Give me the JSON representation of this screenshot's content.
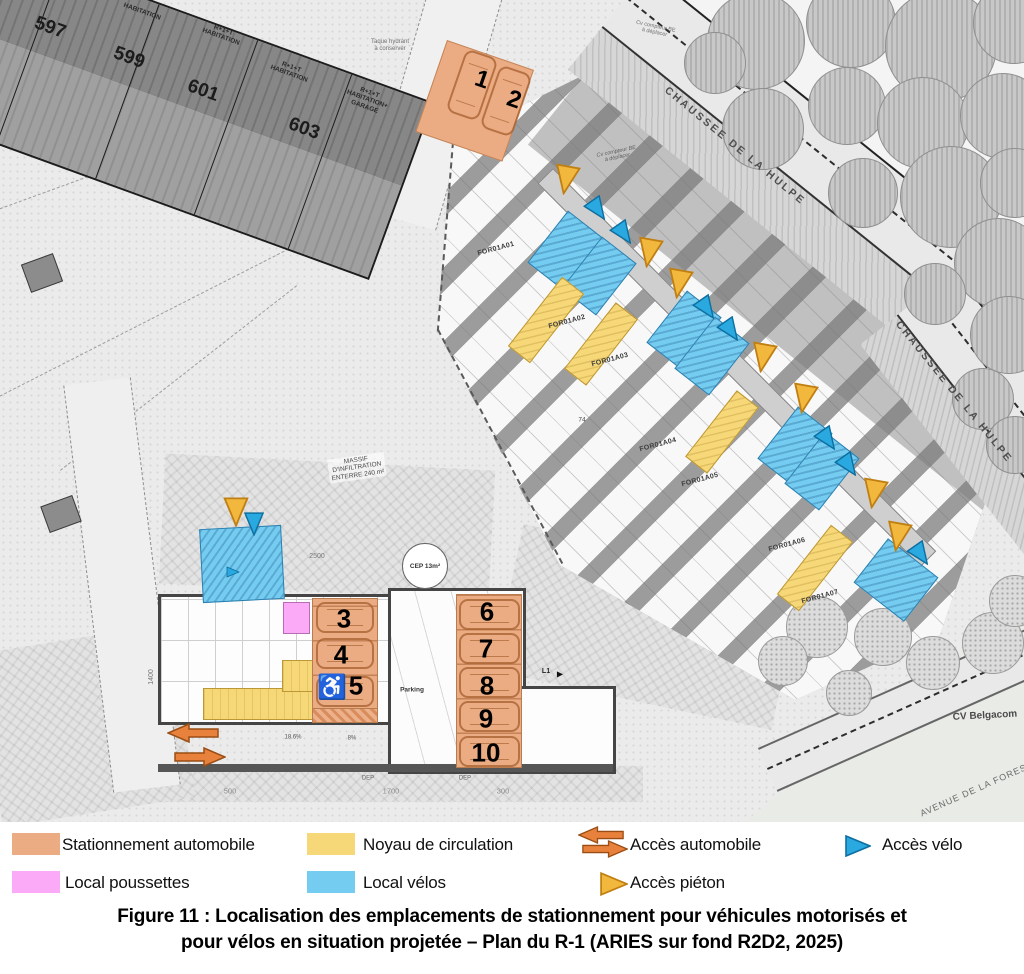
{
  "figure": {
    "caption_line1": "Figure 11 : Localisation des emplacements de stationnement pour véhicules motorisés et",
    "caption_line2": "pour vélos en situation projetée – Plan du R-1 (ARIES sur fond R2D2, 2025)"
  },
  "legend": {
    "items": [
      {
        "label": "Stationnement automobile",
        "swatch": "#ebab83"
      },
      {
        "label": "Noyau de circulation",
        "swatch": "#f7d878"
      },
      {
        "label": "Accès automobile",
        "swatch": "#e8813b"
      },
      {
        "label": "Accès vélo",
        "swatch": "#2aa9e0"
      },
      {
        "label": "Local poussettes",
        "swatch": "#fbaaf8"
      },
      {
        "label": "Local vélos",
        "swatch": "#74cdf0"
      },
      {
        "label": "Accès piéton",
        "swatch": "#f2b83d"
      }
    ]
  },
  "colors": {
    "parking_orange": "#ebab83",
    "core_yellow": "#f7d878",
    "stroller_pink": "#fbaaf8",
    "bike_blue": "#74cdf0",
    "arrow_orange": "#e8813b",
    "pieton_yellow": "#f2b83d",
    "velo_blue": "#2aa9e0"
  },
  "map": {
    "streets": {
      "chaussee_label": "CHAUSSEE DE LA HULPE",
      "avenue_label": "AVENUE DE LA FORESTERIE",
      "cv_belgacom": "CV Belgacom"
    },
    "houses": {
      "numbers": [
        "597",
        "599",
        "601",
        "603"
      ],
      "labels": [
        "HABITATION",
        "R+1+T\nHABITATION",
        "R+1+T\nHABITATION",
        "R+1+T\nHABITATION+\nGARAGE"
      ]
    },
    "unit_labels": [
      "FOR01A01",
      "FOR01A02",
      "FOR01A03",
      "FOR01A04",
      "FOR01A05",
      "FOR01A06",
      "FOR01A07"
    ],
    "spots": [
      "1",
      "2",
      "3",
      "4",
      "5",
      "6",
      "7",
      "8",
      "9",
      "10"
    ],
    "annotations": {
      "taque": "Taque hydrant\nà conserver",
      "cv_compteur": "Cv compteur BE\nà déplacer",
      "massif": "MASSIF\nD'INFILTRATION\nENTERRE 240 m²",
      "cep": "CEP 13m²",
      "parking": "Parking",
      "dim_2500": "2500",
      "dim_1400": "1400",
      "dim_500": "500",
      "dim_1700": "1700",
      "dim_300": "300",
      "dep": "DEP",
      "dim_74": "74",
      "slope_a": "18.6%",
      "slope_b": "8%",
      "l1": "L1",
      "handicap_icon": "♿"
    },
    "features": {
      "bike_rooms": [
        {
          "cx": 242,
          "cy": 564,
          "w": 80,
          "h": 72,
          "rot": -3
        },
        {
          "cx": 565,
          "cy": 250,
          "w": 42,
          "h": 64,
          "rot": 38
        },
        {
          "cx": 599,
          "cy": 276,
          "w": 42,
          "h": 64,
          "rot": 38
        },
        {
          "cx": 684,
          "cy": 330,
          "w": 42,
          "h": 64,
          "rot": 38
        },
        {
          "cx": 712,
          "cy": 356,
          "w": 42,
          "h": 64,
          "rot": 38
        },
        {
          "cx": 795,
          "cy": 446,
          "w": 42,
          "h": 64,
          "rot": 38
        },
        {
          "cx": 822,
          "cy": 471,
          "w": 42,
          "h": 64,
          "rot": 38
        },
        {
          "cx": 896,
          "cy": 580,
          "w": 62,
          "h": 54,
          "rot": 38
        }
      ],
      "cores": [
        {
          "cx": 546,
          "cy": 320,
          "w": 26,
          "h": 86,
          "rot": 38
        },
        {
          "cx": 601,
          "cy": 344,
          "w": 26,
          "h": 82,
          "rot": 38
        },
        {
          "cx": 722,
          "cy": 432,
          "w": 26,
          "h": 82,
          "rot": 38
        },
        {
          "cx": 815,
          "cy": 568,
          "w": 26,
          "h": 86,
          "rot": 38
        }
      ],
      "access_markers": [
        {
          "cx": 566,
          "cy": 180,
          "t": "p",
          "rot": 100
        },
        {
          "cx": 598,
          "cy": 210,
          "t": "v",
          "rot": 55
        },
        {
          "cx": 624,
          "cy": 234,
          "t": "v",
          "rot": 55
        },
        {
          "cx": 649,
          "cy": 253,
          "t": "p",
          "rot": 100
        },
        {
          "cx": 679,
          "cy": 284,
          "t": "p",
          "rot": 100
        },
        {
          "cx": 707,
          "cy": 309,
          "t": "v",
          "rot": 55
        },
        {
          "cx": 731,
          "cy": 331,
          "t": "v",
          "rot": 55
        },
        {
          "cx": 763,
          "cy": 358,
          "t": "p",
          "rot": 100
        },
        {
          "cx": 804,
          "cy": 399,
          "t": "p",
          "rot": 100
        },
        {
          "cx": 828,
          "cy": 440,
          "t": "v",
          "rot": 55
        },
        {
          "cx": 849,
          "cy": 466,
          "t": "v",
          "rot": 55
        },
        {
          "cx": 874,
          "cy": 494,
          "t": "p",
          "rot": 100
        },
        {
          "cx": 898,
          "cy": 537,
          "t": "p",
          "rot": 100
        },
        {
          "cx": 921,
          "cy": 555,
          "t": "v",
          "rot": 55
        },
        {
          "cx": 236,
          "cy": 512,
          "t": "p",
          "rot": 90
        },
        {
          "cx": 254,
          "cy": 524,
          "t": "v",
          "rot": 90
        },
        {
          "cx": 233,
          "cy": 572,
          "t": "v",
          "rot": 0,
          "small": true
        }
      ],
      "car_arrows": [
        {
          "cx": 193,
          "cy": 733,
          "dir": "left"
        },
        {
          "cx": 200,
          "cy": 757,
          "dir": "right"
        }
      ]
    }
  }
}
